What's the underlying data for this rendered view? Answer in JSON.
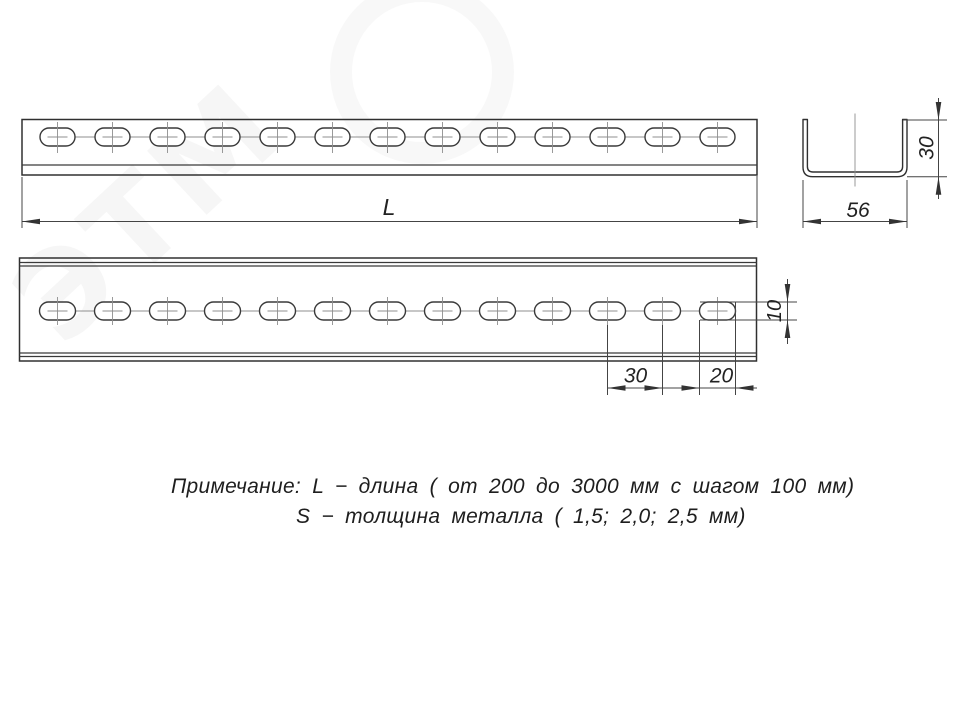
{
  "page": {
    "background": "#ffffff",
    "line_color": "#303030"
  },
  "watermark": {
    "text": "ЭТМ"
  },
  "views": {
    "top_view_holes": 13,
    "front_view_holes": 13
  },
  "dims": {
    "length": "L",
    "section_width": "56",
    "section_height": "30",
    "hole_spacing": "30",
    "hole_length": "20",
    "hole_width": "10"
  },
  "notes": {
    "line1": "Примечание: L − длина ( от 200 до 3000 мм с шагом 100 мм)",
    "line2": "S − толщина металла ( 1,5; 2,0; 2,5 мм)"
  }
}
